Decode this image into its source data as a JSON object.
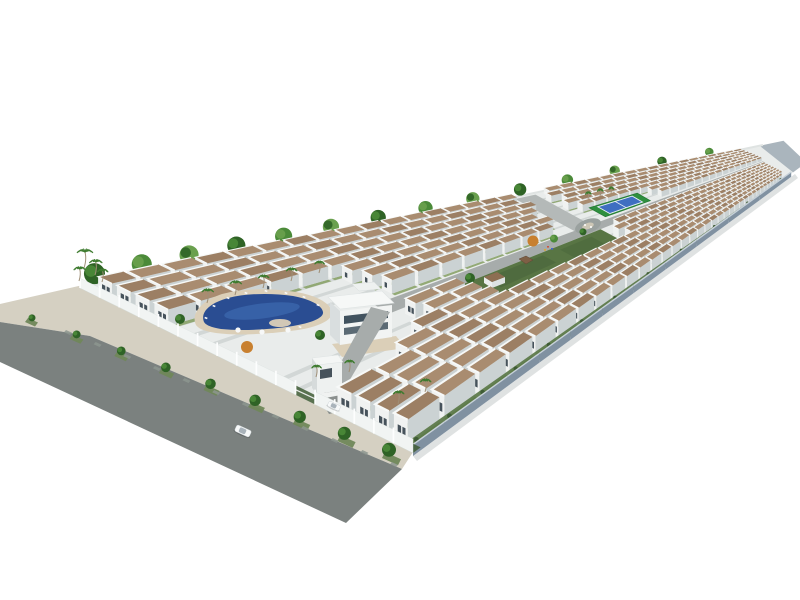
{
  "scene": {
    "title": "Aerial 3D architectural rendering of a gated residential community with rows of white villas, swimming pool, clubhouse, tennis court and central park",
    "background": "plain white studio backdrop",
    "inventory": [
      "housing-rows",
      "swimming-pool",
      "pool-deck",
      "clubhouse",
      "entrance-gatehouse",
      "entrance-driveway",
      "central-avenue",
      "roundabout",
      "central-park",
      "gazebo",
      "park-villa",
      "tennis-court",
      "perimeter-fence",
      "boundary-wall",
      "sidewalk",
      "street",
      "street-trees",
      "palm-trees",
      "back-tree-line",
      "cars"
    ]
  },
  "palette": {
    "bg": "#ffffff",
    "street": "#7b817f",
    "sidewalk": "#d5d0c2",
    "paver": "#8d968f",
    "grass_verge": "#70875a",
    "plot_base": "#e9eceb",
    "lane": "#d2d7d6",
    "house_front": "#f0f2f1",
    "house_shade": "#cbd2d3",
    "roof": "#a98c70",
    "roof_alt": "#9c7f64",
    "parapet": "#f7f9f8",
    "window": "#46525b",
    "yard": "#8aa369",
    "fence": "#f1f4f3",
    "pillar": "#fdfefe",
    "hedge": "#3f5c35",
    "wall_face": "#8091a1",
    "wall_cap": "#c7d1d9",
    "wall_end": "#aab5bd",
    "wall_shadow": "#d2d6d5",
    "back_wall": "#dfe3e2",
    "avenue": "#a7acab",
    "branch_road": "#b4b9b8",
    "roundabout_island": "#cdc7b6",
    "pool_deck": "#dbcfb8",
    "pool_water": "#2a4d92",
    "pool_light": "#4272b8",
    "lounger": "#f7f8f8",
    "park_lawn": "#587544",
    "park_dark": "#46613a",
    "gazebo_roof": "#7e5f45",
    "villa_roof": "#8d6e52",
    "tennis_green": "#2f8f3f",
    "tennis_blue": "#3f6fc1",
    "tennis_line": "#e9eff6",
    "tree_dark": "#2f6326",
    "tree_mid": "#4b8a39",
    "tree_light": "#6aa04e",
    "orange_tree": "#c8802f",
    "palm_frond": "#3e7b2f",
    "palm_trunk": "#9f8f77",
    "car_body": "#f7f9f9",
    "car_glass": "#a9b3ba"
  },
  "config": {
    "units_per_row": 40,
    "house_rows": 15,
    "fence_panels": 17,
    "back_trees": 14,
    "sidewalk_trees": 9,
    "sidewalk_pavers": 12,
    "pool_loungers": 9,
    "pool_umbrellas": 3,
    "palm_trees": 16,
    "cars": 2
  }
}
